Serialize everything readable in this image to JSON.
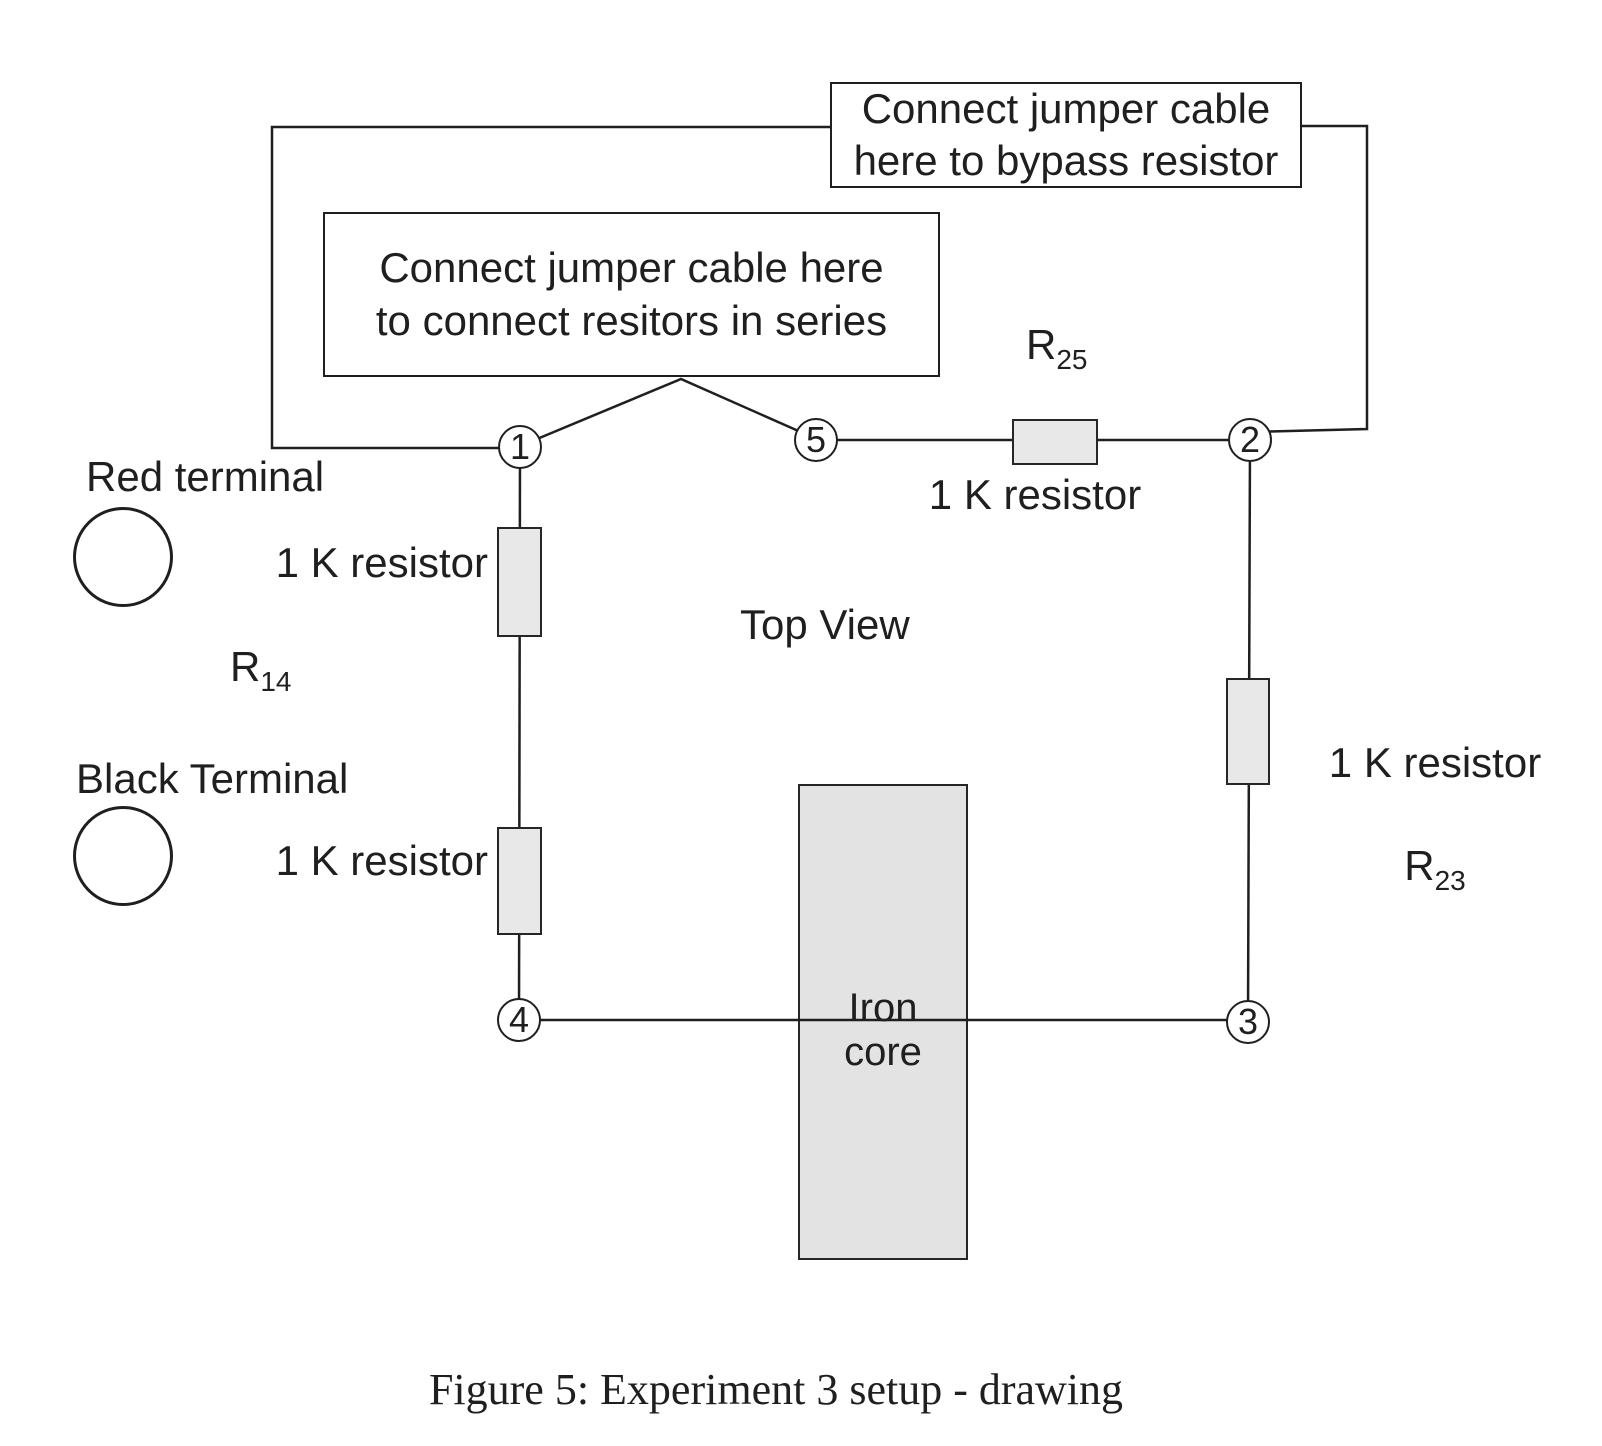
{
  "colors": {
    "background": "#ffffff",
    "wire": "#1f1f1f",
    "resistor_fill": "#e8e8e8",
    "iron_core_fill": "#e3e3e3"
  },
  "callouts": {
    "bypass": "Connect jumper cable\nhere to bypass resistor",
    "series": "Connect jumper cable here\nto connect resitors in series"
  },
  "nodes": {
    "n1": "1",
    "n2": "2",
    "n3": "3",
    "n4": "4",
    "n5": "5"
  },
  "terminals": {
    "red": "Red terminal",
    "black": "Black Terminal"
  },
  "resistors": {
    "r14": {
      "ref": "R",
      "sub": "14",
      "value_upper": "1 K resistor",
      "value_lower": "1 K resistor"
    },
    "r25": {
      "ref": "R",
      "sub": "25",
      "value": "1 K resistor"
    },
    "r23": {
      "ref": "R",
      "sub": "23",
      "value": "1 K resistor"
    }
  },
  "view": {
    "top_view": "Top View",
    "iron_core": "Iron\ncore"
  },
  "caption": "Figure 5: Experiment 3 setup - drawing"
}
